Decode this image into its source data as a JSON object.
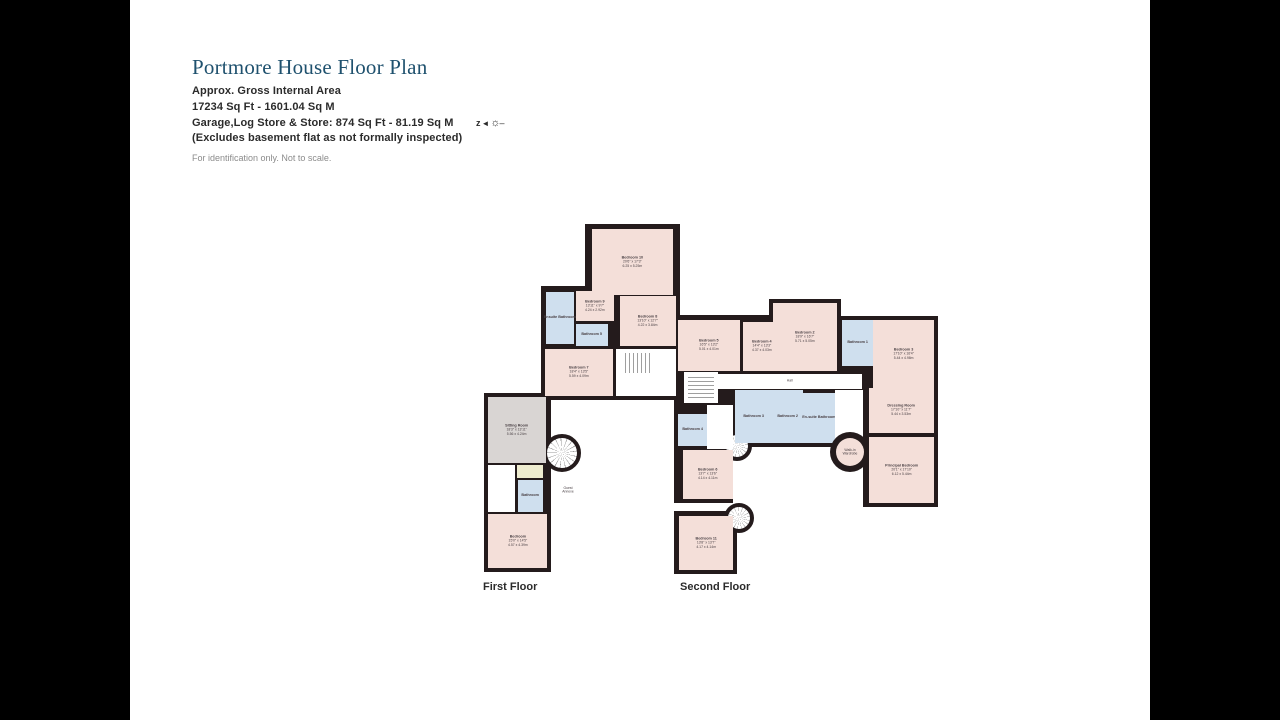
{
  "header": {
    "title": "Portmore House Floor Plan",
    "line1": "Approx. Gross Internal Area",
    "line2": "17234 Sq Ft - 1601.04 Sq M",
    "line3": "Garage,Log Store & Store: 874 Sq Ft - 81.19 Sq M",
    "line4": "(Excludes basement flat as not formally inspected)",
    "disclaimer": "For identification only. Not to scale.",
    "compass": {
      "letter": "z",
      "arrow": "◄",
      "sun": "☼",
      "dash": "–"
    }
  },
  "plan": {
    "colors": {
      "wall": "#241b1c",
      "bedroom_fill": "#f4dfd9",
      "bathroom_fill": "#cfdfee",
      "sitting_fill": "#d9d5d3",
      "utility_fill": "#eeeccf",
      "title_color": "#1f516e"
    },
    "floor_labels": {
      "first": "First Floor",
      "second": "Second Floor"
    },
    "rooms": {
      "bedroom10": {
        "name": "Bedroom 10",
        "imperial": "20'6\" x 17'3\"",
        "metric": "6.25 x 5.25m"
      },
      "bedroom9": {
        "name": "Bedroom 9",
        "imperial": "13'11\" x 9'7\"",
        "metric": "4.24 x 2.92m"
      },
      "bedroom8": {
        "name": "Bedroom 8",
        "imperial": "13'10\" x 12'7\"",
        "metric": "4.22 x 3.84m"
      },
      "bedroom7": {
        "name": "Bedroom 7",
        "imperial": "18'4\" x 13'5\"",
        "metric": "5.59 x 4.09m"
      },
      "bedroom5": {
        "name": "Bedroom 5",
        "imperial": "16'5\" x 13'2\"",
        "metric": "5.01 x 4.01m"
      },
      "bedroom4": {
        "name": "Bedroom 4",
        "imperial": "14'4\" x 13'3\"",
        "metric": "4.37 x 4.03m"
      },
      "bedroom2": {
        "name": "Bedroom 2",
        "imperial": "18'9\" x 16'7\"",
        "metric": "5.71 x 5.05m"
      },
      "bedroom3": {
        "name": "Bedroom 3",
        "imperial": "17'10\" x 16'4\"",
        "metric": "5.44 x 4.98m"
      },
      "bedroom6": {
        "name": "Bedroom 6",
        "imperial": "13'7\" x 13'6\"",
        "metric": "4.14 x 4.11m"
      },
      "bedroom11": {
        "name": "Bedroom 11",
        "imperial": "13'8\" x 13'7\"",
        "metric": "4.17 x 4.14m"
      },
      "principal_bedroom": {
        "name": "Principal Bedroom",
        "imperial": "20'1\" x 17'10\"",
        "metric": "6.12 x 5.44m"
      },
      "dressing_room": {
        "name": "Dressing Room",
        "imperial": "17'10\" x 11'7\"",
        "metric": "5.44 x 3.53m"
      },
      "sitting_room": {
        "name": "Sitting Room",
        "imperial": "18'3\" x 13'11\"",
        "metric": "5.56 x 4.24m"
      },
      "wing_bedroom": {
        "name": "Bedroom",
        "imperial": "15'0\" x 14'5\"",
        "metric": "4.57 x 4.39m"
      },
      "wing_bathroom": {
        "name": "Bathroom"
      },
      "ensuite_bathroom_first": {
        "name": "Ensuite Bathroom"
      },
      "ensuite_bathroom_main": {
        "name": "En-suite Bathroom"
      },
      "bathroom1": {
        "name": "Bathroom 1"
      },
      "bathroom2": {
        "name": "Bathroom 2"
      },
      "bathroom3": {
        "name": "Bathroom 3"
      },
      "bathroom4": {
        "name": "Bathroom 4"
      },
      "bathroom5": {
        "name": "Bathroom 5"
      },
      "walk_in_wardrobe": {
        "name": "Walk-in Wardrobe"
      },
      "hall": {
        "name": "Hall"
      },
      "guest_annexe": {
        "name": "Guest Annexe"
      }
    }
  }
}
